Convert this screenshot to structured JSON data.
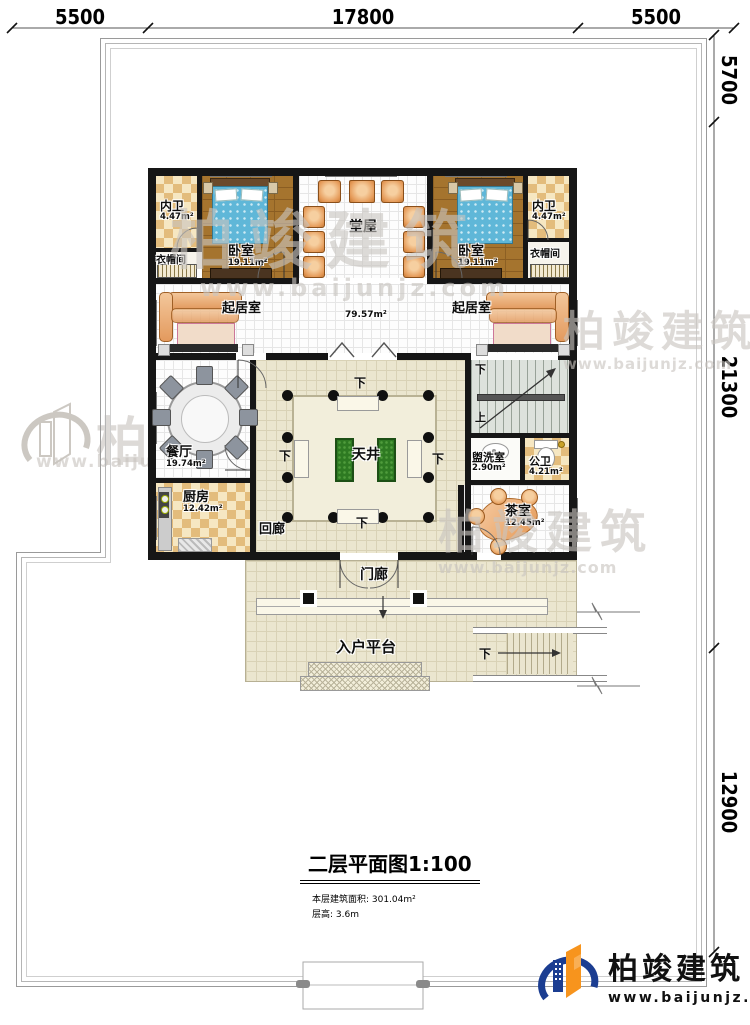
{
  "dimensions": {
    "top": [
      "5500",
      "17800",
      "5500"
    ],
    "right": [
      "5700",
      "21300",
      "12900"
    ]
  },
  "plan": {
    "central_area": "79.57m²",
    "rooms": {
      "neiwei_left": {
        "name": "内卫",
        "area": "4.47m²"
      },
      "bedroom_left": {
        "name": "卧室",
        "area": "19.11m²"
      },
      "cloak_left": {
        "name": "衣帽间"
      },
      "tangwu": {
        "name": "堂屋"
      },
      "bedroom_right": {
        "name": "卧室",
        "area": "19.11m²"
      },
      "neiwei_right": {
        "name": "内卫",
        "area": "4.47m²"
      },
      "cloak_right": {
        "name": "衣帽间"
      },
      "living_left": {
        "name": "起居室"
      },
      "living_right": {
        "name": "起居室"
      },
      "dining": {
        "name": "餐厅",
        "area": "19.74m²"
      },
      "kitchen": {
        "name": "厨房",
        "area": "12.42m²"
      },
      "courtyard": {
        "name": "天井"
      },
      "corridor": {
        "name": "回廊"
      },
      "washroom": {
        "name": "盥洗室",
        "area": "2.90m²"
      },
      "toilet": {
        "name": "公卫",
        "area": "4.21m²"
      },
      "tearoom": {
        "name": "茶室",
        "area": "12.45m²"
      },
      "porch": {
        "name": "门廊"
      },
      "platform": {
        "name": "入户平台"
      }
    },
    "nav": {
      "down": "下",
      "up": "上"
    }
  },
  "titleblock": {
    "title": "二层平面图1:100",
    "area_line": "本层建筑面积: 301.04m²",
    "height_line": "层高: 3.6m"
  },
  "logo": {
    "brand": "柏竣建筑",
    "site": "www.baijunjz.com"
  },
  "watermark": {
    "brand": "柏竣建筑",
    "site": "www.baijunjz.com"
  }
}
